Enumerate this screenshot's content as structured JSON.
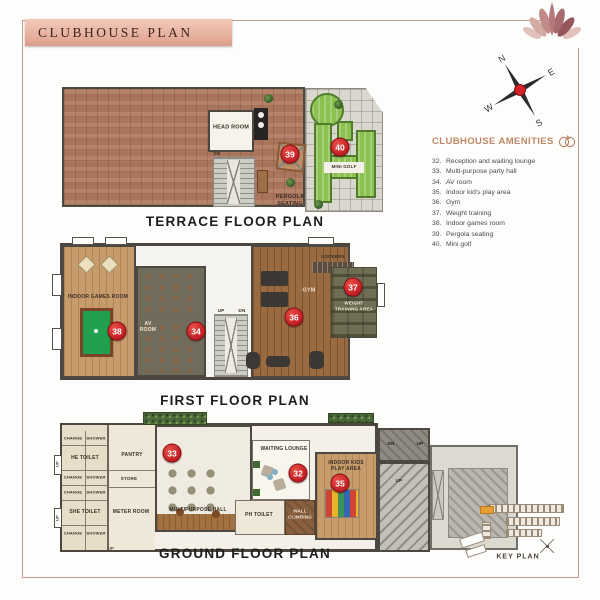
{
  "page": {
    "title": "CLUBHOUSE PLAN"
  },
  "colors": {
    "accent_red": "#c01e24",
    "frame_rose": "#c69a8d",
    "banner_rose": "#e2a895",
    "golf_green": "#8cc152",
    "terrace_brown": "#b07b62"
  },
  "compass": {
    "n": "N",
    "e": "E",
    "s": "S",
    "w": "W"
  },
  "amenities": {
    "title": "CLUBHOUSE AMENITIES",
    "items": [
      {
        "num": "32.",
        "label": "Reception and waiting lounge"
      },
      {
        "num": "33.",
        "label": "Multi-purpose party hall"
      },
      {
        "num": "34.",
        "label": "AV room"
      },
      {
        "num": "35.",
        "label": "Indoor kid's play area"
      },
      {
        "num": "36.",
        "label": "Gym"
      },
      {
        "num": "37.",
        "label": "Weight training"
      },
      {
        "num": "38.",
        "label": "Indoor games room"
      },
      {
        "num": "39.",
        "label": "Pergola seating"
      },
      {
        "num": "40.",
        "label": "Mini golf"
      }
    ]
  },
  "markers": {
    "m32": "32",
    "m33": "33",
    "m34": "34",
    "m35": "35",
    "m36": "36",
    "m37": "37",
    "m38": "38",
    "m39": "39",
    "m40": "40"
  },
  "common": {
    "up": "UP",
    "dn": "DN",
    "change": "CHANGE",
    "shower": "SHOWER"
  },
  "floors": {
    "terrace": {
      "title": "TERRACE FLOOR PLAN",
      "rooms": {
        "head_room": "HEAD ROOM",
        "pergola_seating": "PERGOLA SEATING",
        "mini_golf": "MINI GOLF"
      }
    },
    "first": {
      "title": "FIRST FLOOR PLAN",
      "rooms": {
        "indoor_games": "INDOOR GAMES ROOM",
        "av_room": "AV ROOM",
        "lockers": "LOCKERS",
        "gym": "GYM",
        "weight_training": "WEIGHT TRAINING AREA"
      }
    },
    "ground": {
      "title": "GROUND FLOOR PLAN",
      "rooms": {
        "he_toilet": "HE TOILET",
        "she_toilet": "SHE TOILET",
        "pantry": "PANTRY",
        "store": "STORE",
        "meter_room": "METER ROOM",
        "multipurpose_hall": "MULTIPURPOSE HALL",
        "waiting_lounge": "WAITING LOUNGE",
        "ph_toilet": "PH TOILET",
        "wall_climbing": "WALL CLIMBING",
        "kids_play": "INDOOR KIDS PLAY AREA"
      }
    }
  },
  "key_plan": {
    "label": "KEY PLAN"
  }
}
